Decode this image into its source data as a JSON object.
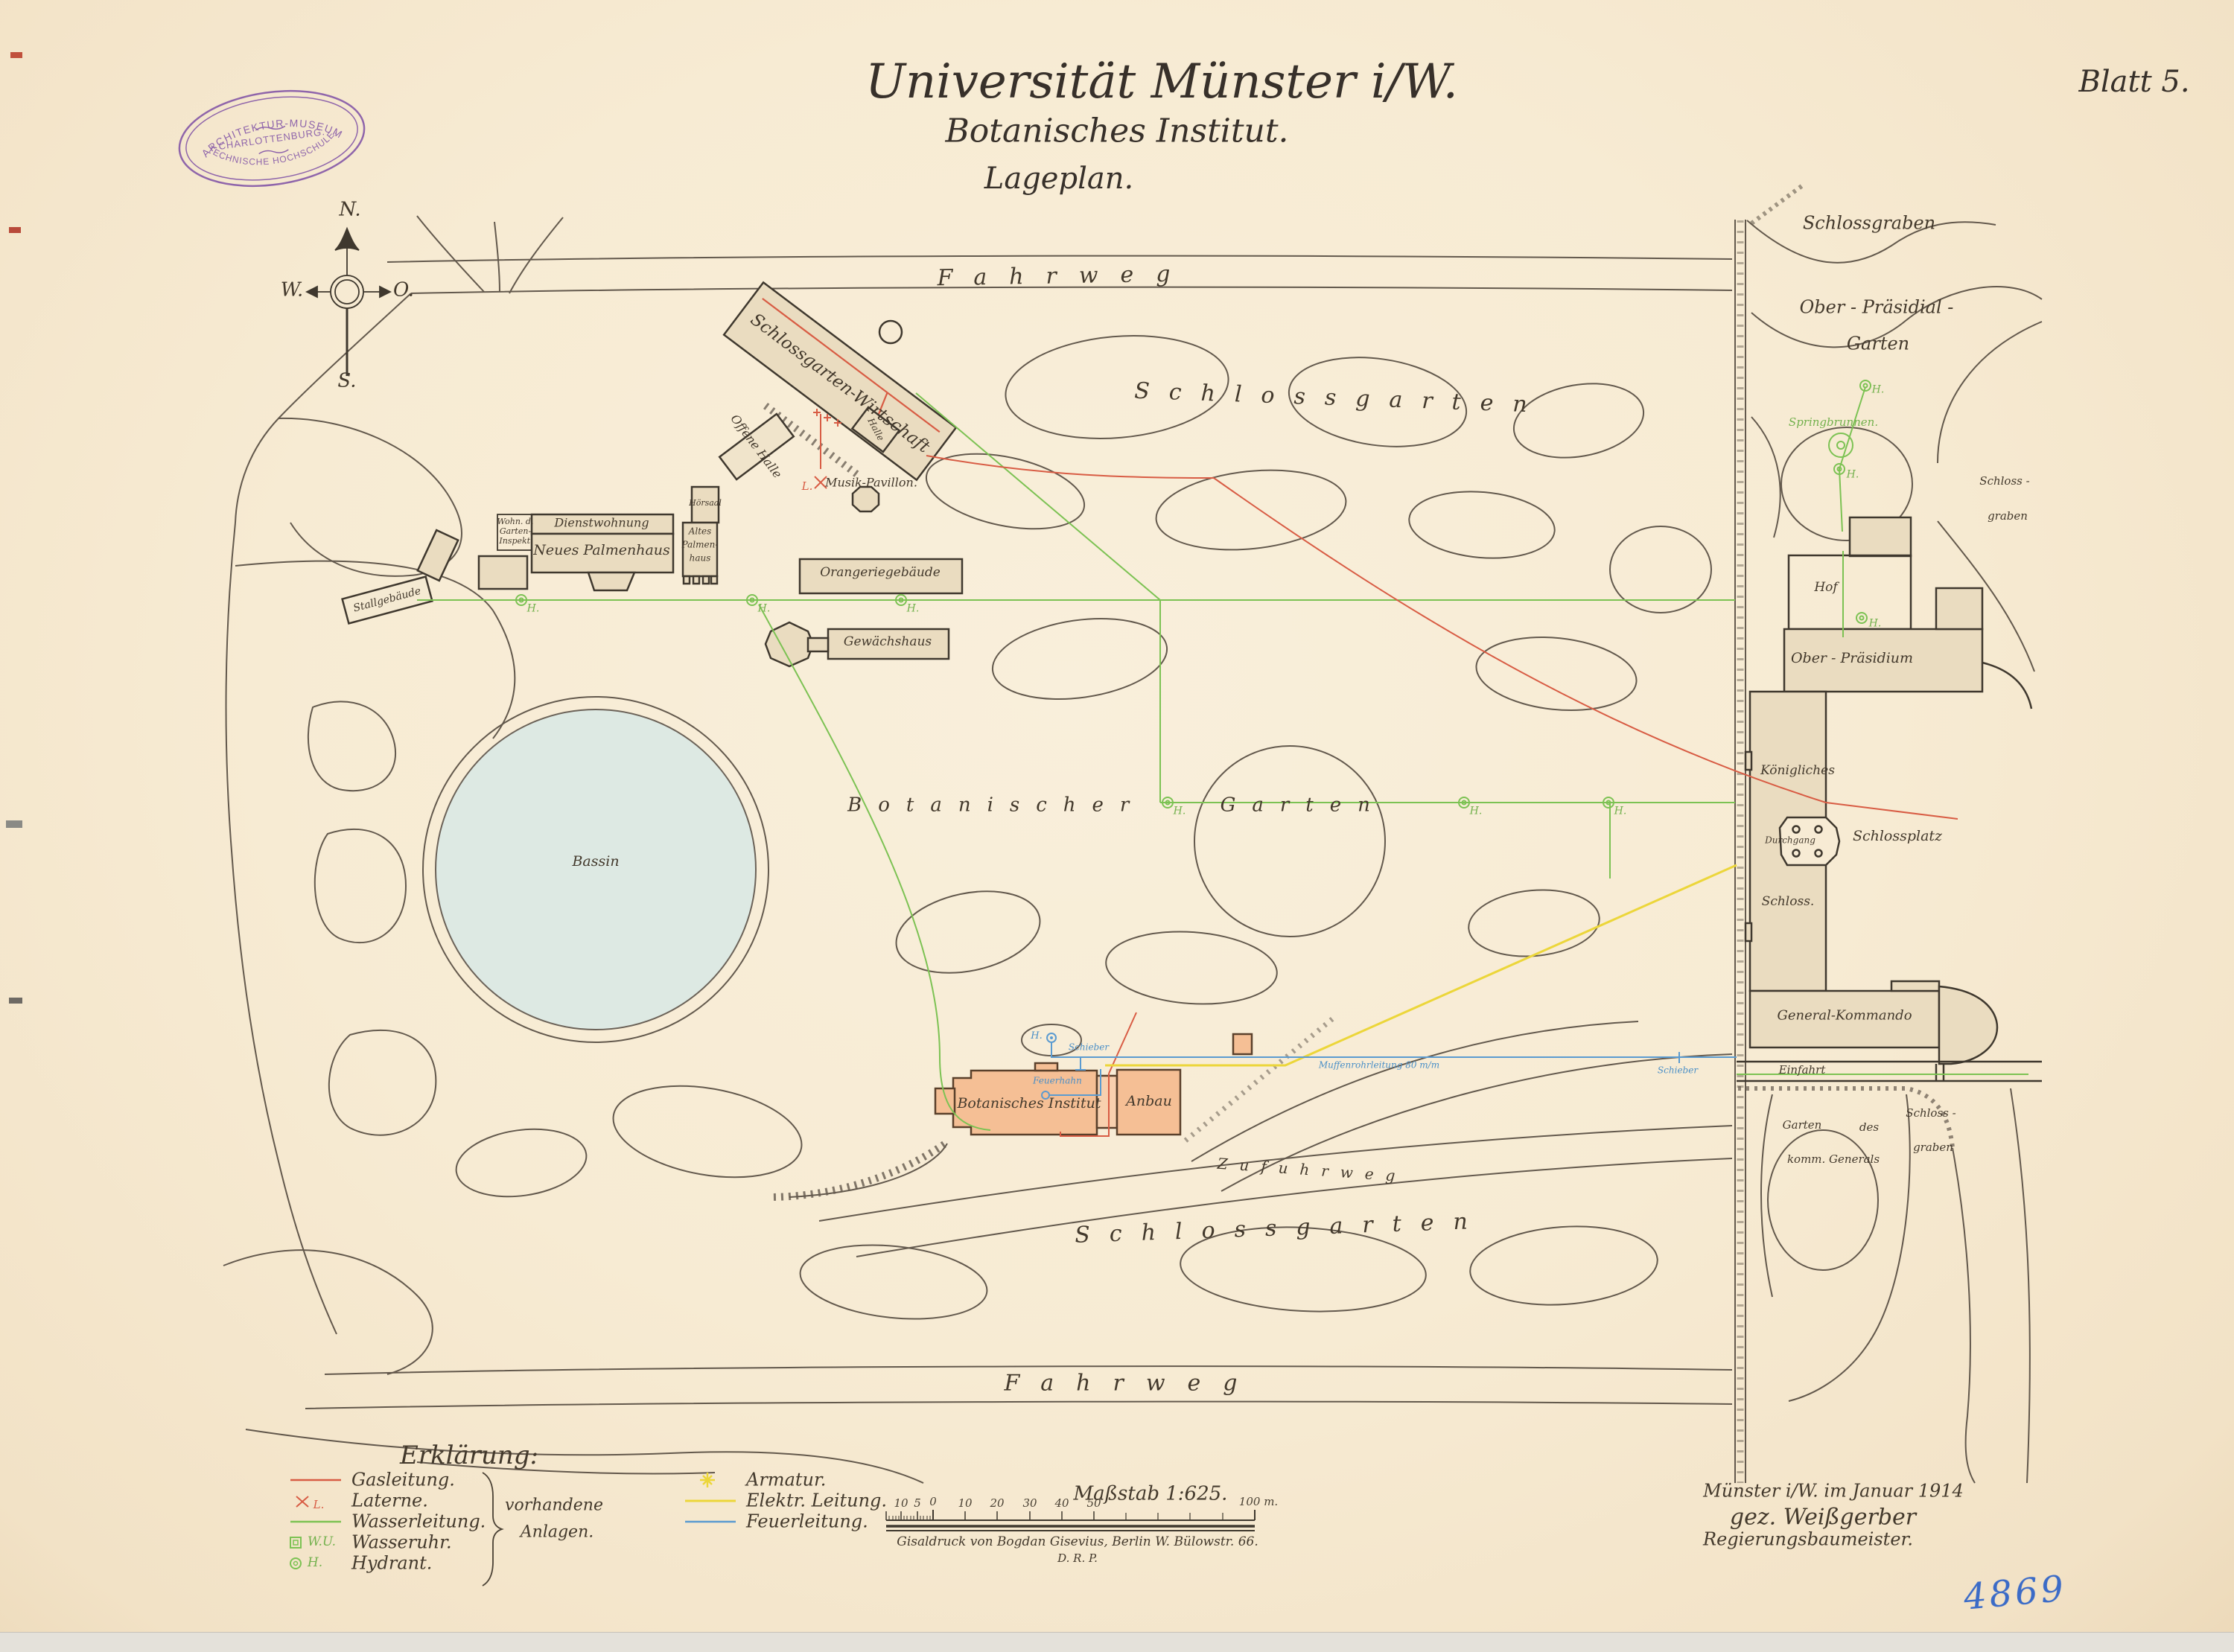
{
  "header": {
    "title1": "Universität Münster i/W.",
    "title2": "Botanisches Institut.",
    "title3": "Lageplan.",
    "sheet": "Blatt 5."
  },
  "stamp": {
    "line1": "ARCHITEKTUR-MUSEUM",
    "line2": "CHARLOTTENBURG.",
    "line3": "TECHNISCHE HOCHSCHULE."
  },
  "compass": {
    "n": "N.",
    "w": "W.",
    "e": "O.",
    "s": "S."
  },
  "map": {
    "symbols": {
      "hydrant": "H.",
      "wasseruhr": "W.U.",
      "laterne": "L."
    },
    "labels": [
      {
        "id": "fahrweg-top",
        "text": "Fahrweg"
      },
      {
        "id": "schlossgarten-top",
        "text": "Schlossgarten"
      },
      {
        "id": "schlossgraben-topright",
        "text": "Schlossgraben"
      },
      {
        "id": "ober-praesidial-1",
        "text": "Ober - Präsidial -"
      },
      {
        "id": "ober-praesidial-2",
        "text": "Garten"
      },
      {
        "id": "springbrunnen",
        "text": "Springbrunnen."
      },
      {
        "id": "schlossgarten-wirtschaft",
        "text": "Schlossgarten-Wirtschaft"
      },
      {
        "id": "offene-halle",
        "text": "Offene Halle"
      },
      {
        "id": "halle",
        "text": "Halle"
      },
      {
        "id": "musik-pavillon",
        "text": "Musik-Pavillon."
      },
      {
        "id": "stallgebaeude",
        "text": "Stallgebäude"
      },
      {
        "id": "wohn-1",
        "text": "Wohn. d."
      },
      {
        "id": "wohn-2",
        "text": "Garten-"
      },
      {
        "id": "wohn-3",
        "text": "Inspekt."
      },
      {
        "id": "dienstwohnung",
        "text": "Dienstwohnung"
      },
      {
        "id": "neues-palmenhaus",
        "text": "Neues Palmenhaus"
      },
      {
        "id": "altes-1",
        "text": "Altes"
      },
      {
        "id": "altes-2",
        "text": "Palmen-"
      },
      {
        "id": "altes-3",
        "text": "haus"
      },
      {
        "id": "hoersaal",
        "text": "Hörsaal"
      },
      {
        "id": "orangeriegebaeude",
        "text": "Orangeriegebäude"
      },
      {
        "id": "gewaechshaus",
        "text": "Gewächshaus"
      },
      {
        "id": "bassin",
        "text": "Bassin"
      },
      {
        "id": "botanischer-garten",
        "text": "Botanischer Garten"
      },
      {
        "id": "botanisches-institut",
        "text": "Botanisches Institut"
      },
      {
        "id": "feuerhahn",
        "text": "Feuerhahn"
      },
      {
        "id": "anbau",
        "text": "Anbau"
      },
      {
        "id": "schieber-1",
        "text": "Schieber"
      },
      {
        "id": "muffenrohrleitung",
        "text": "Muffenrohrleitung 80 m/m"
      },
      {
        "id": "schieber-2",
        "text": "Schieber"
      },
      {
        "id": "zufuhrweg",
        "text": "Zufuhrweg"
      },
      {
        "id": "schlossgarten-bottom",
        "text": "Schlossgarten"
      },
      {
        "id": "fahrweg-bottom",
        "text": "Fahrweg"
      },
      {
        "id": "hof",
        "text": "Hof"
      },
      {
        "id": "ober-praesidium",
        "text": "Ober - Präsidium"
      },
      {
        "id": "koenigliches",
        "text": "Königliches"
      },
      {
        "id": "schlossplatz",
        "text": "Schlossplatz"
      },
      {
        "id": "durchgang",
        "text": "Durchgang"
      },
      {
        "id": "schloss",
        "text": "Schloss."
      },
      {
        "id": "general-kommando",
        "text": "General-Kommando"
      },
      {
        "id": "einfahrt",
        "text": "Einfahrt"
      },
      {
        "id": "schlossgraben-mid-1",
        "text": "Schloss -"
      },
      {
        "id": "schlossgraben-mid-2",
        "text": "graben"
      },
      {
        "id": "schlossgraben-bot-1",
        "text": "Schloss -"
      },
      {
        "id": "schlossgraben-bot-2",
        "text": "graben"
      },
      {
        "id": "garten-des-1",
        "text": "Garten"
      },
      {
        "id": "garten-des-2",
        "text": "des"
      },
      {
        "id": "garten-des-3",
        "text": "komm. Generals"
      }
    ]
  },
  "legend": {
    "heading": "Erklärung:",
    "items_left": [
      {
        "label": "Gasleitung."
      },
      {
        "label": "Laterne."
      },
      {
        "label": "Wasserleitung."
      },
      {
        "label": "Wasseruhr."
      },
      {
        "label": "Hydrant."
      }
    ],
    "brace_note1": "vorhandene",
    "brace_note2": "Anlagen.",
    "items_right": [
      {
        "label": "Armatur."
      },
      {
        "label": "Elektr. Leitung."
      },
      {
        "label": "Feuerleitung."
      }
    ]
  },
  "scale": {
    "caption": "Maßstab 1:625.",
    "ticks": [
      "10",
      "5",
      "0",
      "10",
      "20",
      "30",
      "40",
      "50"
    ],
    "end_label": "100 m.",
    "credit1": "Gisaldruck von Bogdan Gisevius, Berlin W. Bülowstr. 66.",
    "credit2": "D. R. P."
  },
  "signature": {
    "line1": "Münster i/W. im Januar 1914",
    "line2": "gez. Weißgerber",
    "line3": "Regierungsbaumeister.",
    "archive_number": "4869"
  },
  "colors": {
    "paper": "#f7ebd4",
    "gas_red": "#d85c44",
    "water_green": "#7cc253",
    "electric_yellow": "#ecd63a",
    "fire_blue": "#5b9bd0",
    "stamp_purple": "#7e4fa5",
    "building_beige": "#eadcc0",
    "building_orange": "#f5bf95",
    "bassin_blue": "#dde9e3"
  }
}
